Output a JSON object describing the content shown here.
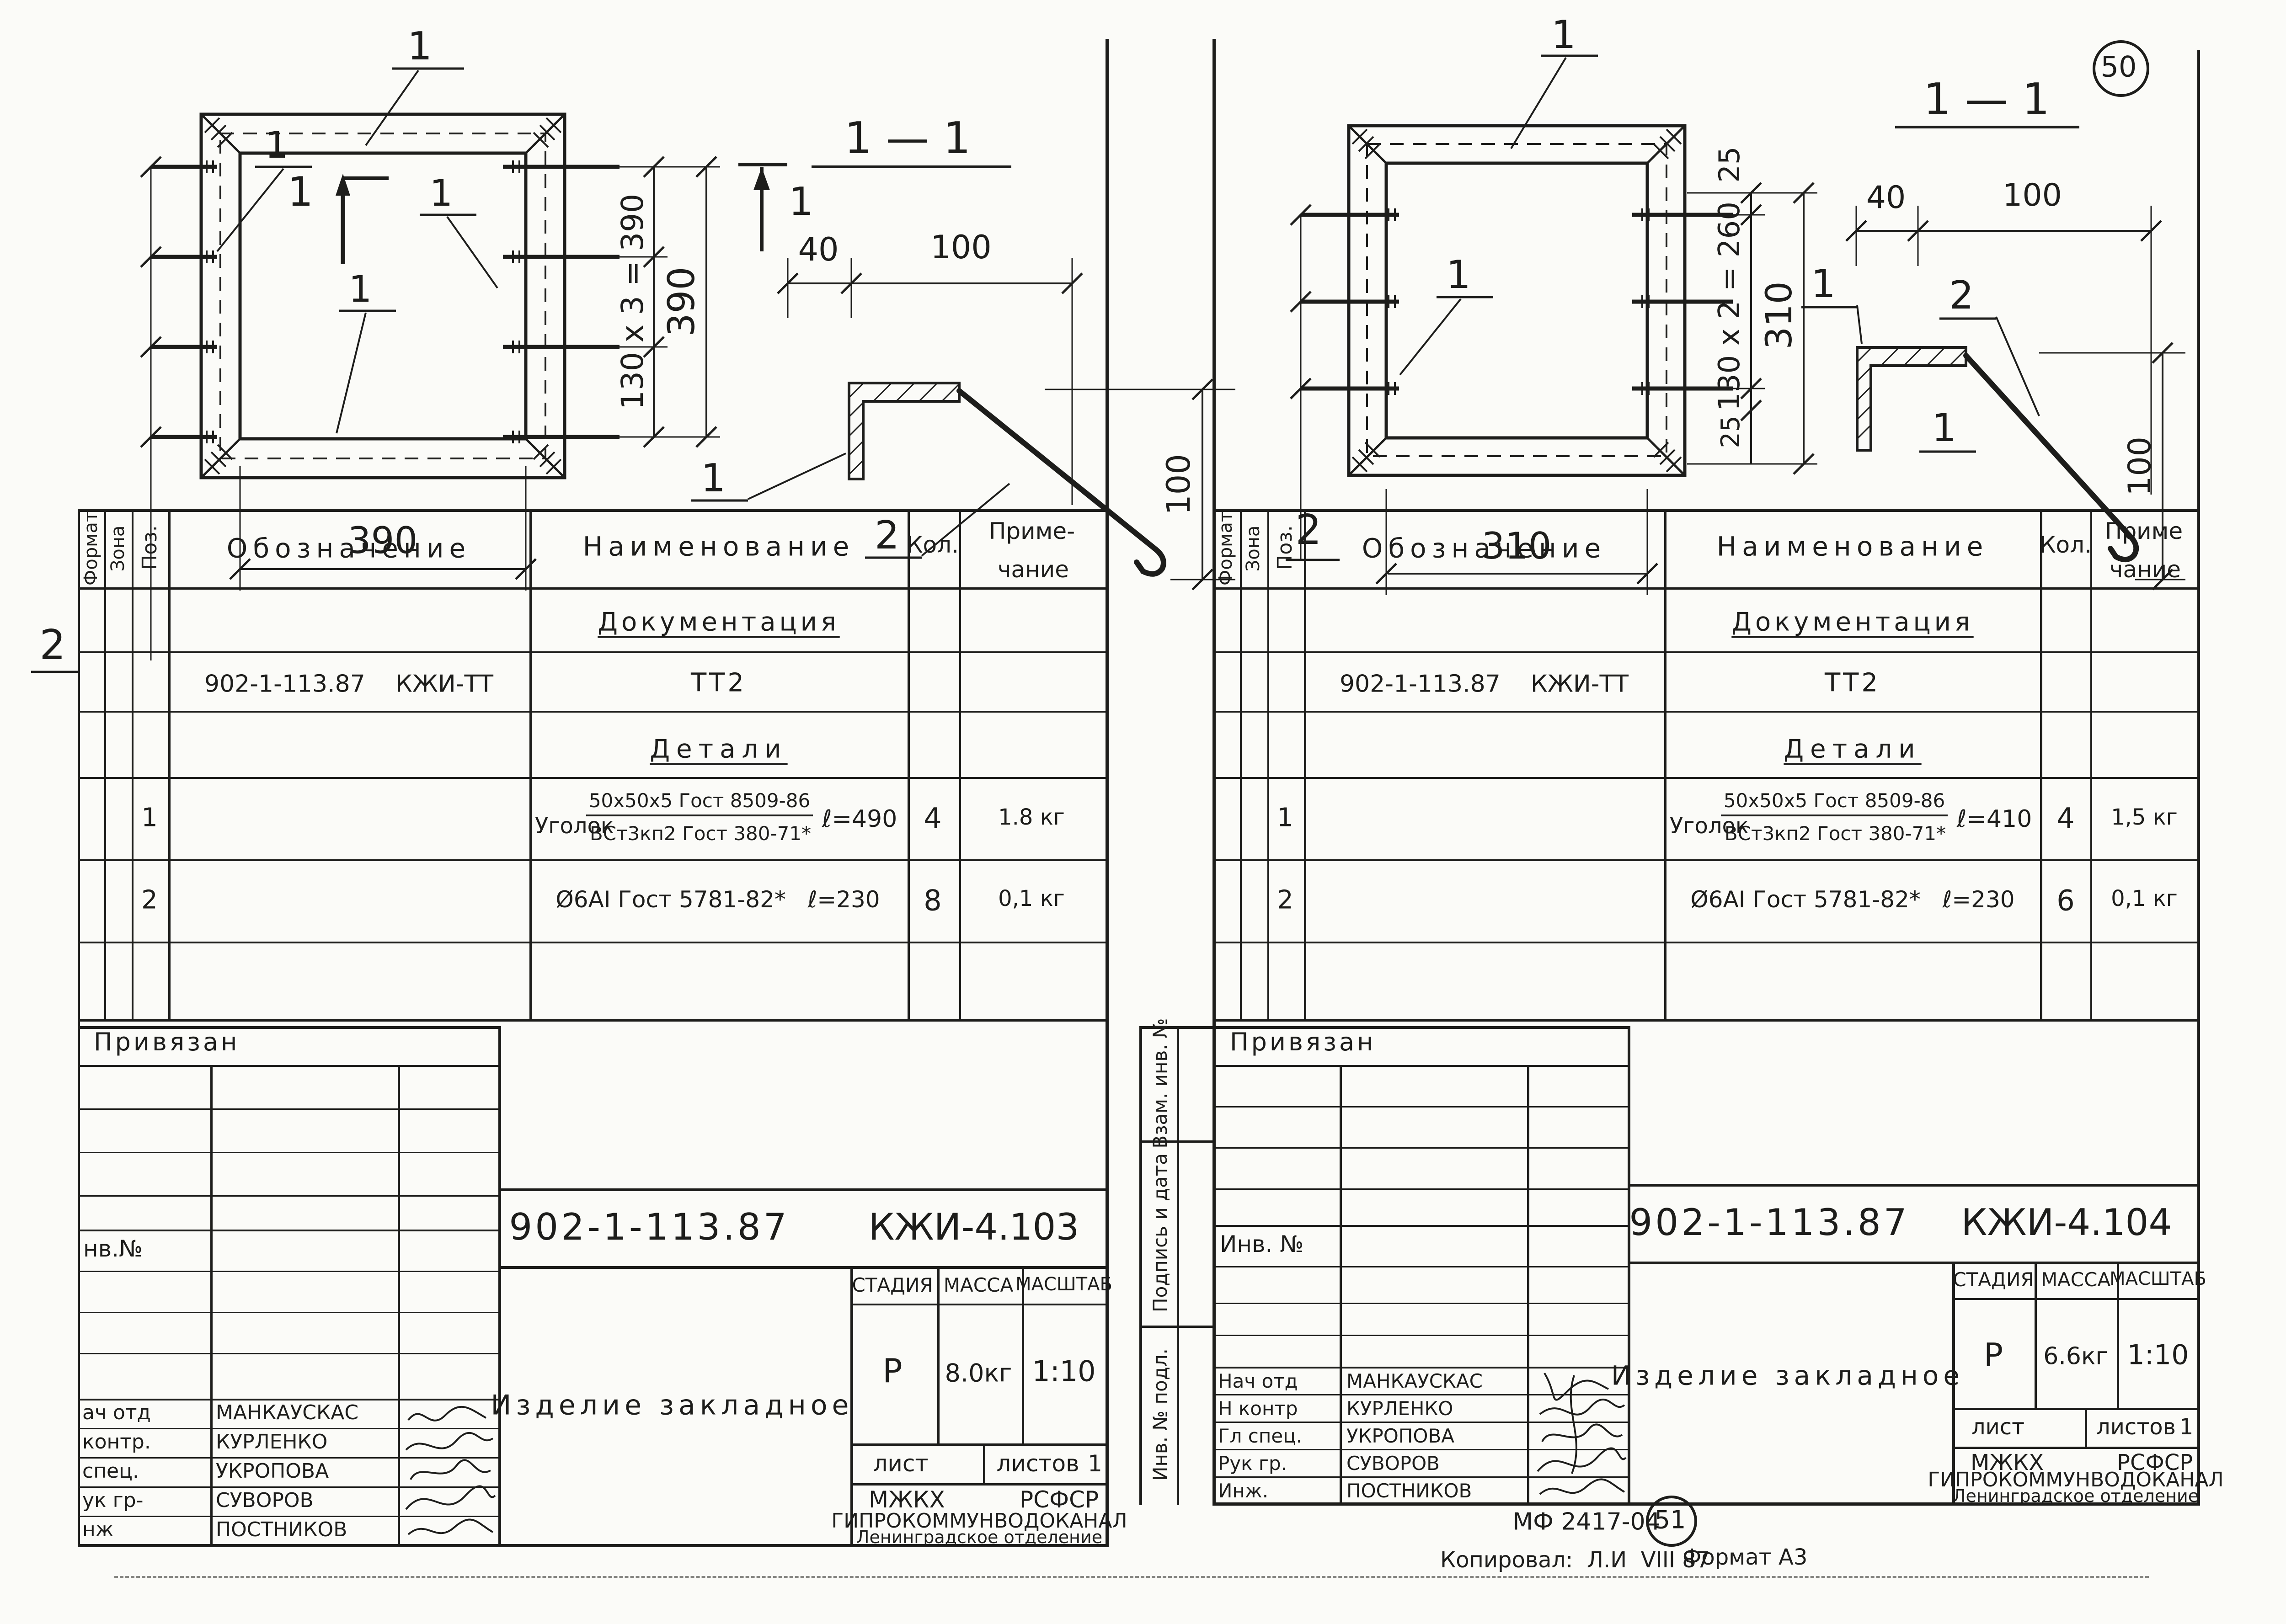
{
  "corner_mark": "50",
  "footer": {
    "stamp_code": "МФ 2417-04",
    "stamp_circle": "51",
    "copied": "Копировал:  Л.И  VIII 87",
    "format": "Формат А3"
  },
  "left": {
    "plan": {
      "l1_top": "1",
      "l1_left": "1",
      "l1_right": "1",
      "l1_bottom": "1",
      "sec_c": "1",
      "sec_r": "1",
      "label_2": "2",
      "dim_pitch": "130 x 3 = 390",
      "dim_side": "390",
      "dim_bottom": "390"
    },
    "sec": {
      "title": "1 — 1",
      "d40": "40",
      "d100": "100",
      "dh": "100",
      "p1": "1",
      "p2": "2"
    },
    "tbl": {
      "h_format": "Формат",
      "h_zone": "Зона",
      "h_pos": "Поз.",
      "h_desig": "Обозначение",
      "h_name": "Наименование",
      "h_qty": "Кол.",
      "h_note1": "Приме-",
      "h_note2": "чание",
      "s_doc": "Документация",
      "doc_desig": "902-1-113.87    КЖИ-ТТ",
      "doc_name": "ТТ2",
      "s_det": "Детали",
      "i1_pos": "1",
      "i1_pre": "Уголок",
      "i1_ft": "50x50x5 Гост 8509-86",
      "i1_fb": "ВСт3кп2 Гост 380-71*",
      "i1_len": "ℓ=490",
      "i1_qty": "4",
      "i1_note": "1.8 кг",
      "i2_pos": "2",
      "i2_name": "Ø6АI Гост 5781-82*   ℓ=230",
      "i2_qty": "8",
      "i2_note": "0,1 кг"
    },
    "stamp": {
      "top": "Привязан",
      "inv": "нв.№",
      "r1l": "ач отд",
      "r1n": "МАНКАУСКАС",
      "r2l": "контр.",
      "r2n": "КУРЛЕНКО",
      "r3l": "спец.",
      "r3n": "УКРОПОВА",
      "r4l": "ук гр-",
      "r4n": "СУВОРОВ",
      "r5l": "нж",
      "r5n": "ПОСТНИКОВ"
    },
    "tb": {
      "doc": "902-1-113.87",
      "code": "КЖИ-4.103",
      "product": "Изделие закладное",
      "stage_h": "СТАДИЯ",
      "mass_h": "МАССА",
      "scale_h": "МАСШТАБ",
      "stage": "Р",
      "mass": "8.0кг",
      "scale": "1:10",
      "sheet": "лист",
      "sheets": "листов",
      "sheets_n": "1",
      "org_a": "МЖКХ",
      "org_b": "РСФСР",
      "org_main": "ГИПРОКОММУНВОДОКАНАЛ",
      "org_br": "Ленинградское отделение"
    }
  },
  "right": {
    "plan": {
      "l1_top": "1",
      "l1_left": "1",
      "sec_r": "1",
      "label_2": "2",
      "dim_25t": "25",
      "dim_pitch": "130 x 2 = 260",
      "dim_25b": "25",
      "dim_side": "310",
      "dim_bottom": "310"
    },
    "sec": {
      "title": "1 — 1",
      "d40": "40",
      "d100": "100",
      "dh": "100",
      "p1": "1",
      "p2": "2"
    },
    "tbl": {
      "h_format": "Формат",
      "h_zone": "Зона",
      "h_pos": "Поз.",
      "h_desig": "Обозначение",
      "h_name": "Наименование",
      "h_qty": "Кол.",
      "h_note1": "Приме",
      "h_note2": "чание",
      "s_doc": "Документация",
      "doc_desig": "902-1-113.87    КЖИ-ТТ",
      "doc_name": "ТТ2",
      "s_det": "Детали",
      "i1_pos": "1",
      "i1_pre": "Уголок",
      "i1_ft": "50x50x5 Гост 8509-86",
      "i1_fb": "ВСт3кп2 Гост 380-71*",
      "i1_len": "ℓ=410",
      "i1_qty": "4",
      "i1_note": "1,5 кг",
      "i2_pos": "2",
      "i2_name": "Ø6АI Гост 5781-82*   ℓ=230",
      "i2_qty": "6",
      "i2_note": "0,1 кг"
    },
    "stamp": {
      "top": "Привязан",
      "inv": "Инв. №",
      "r1l": "Нач отд",
      "r1n": "МАНКАУСКАС",
      "r2l": "Н контр",
      "r2n": "КУРЛЕНКО",
      "r3l": "Гл спец.",
      "r3n": "УКРОПОВА",
      "r4l": "Рук гр.",
      "r4n": "СУВОРОВ",
      "r5l": "Инж.",
      "r5n": "ПОСТНИКОВ"
    },
    "sidebar": {
      "a": "Взам. инв. №",
      "b": "Подпись и дата",
      "c": "Инв. № подл."
    },
    "tb": {
      "doc": "902-1-113.87",
      "code": "КЖИ-4.104",
      "product": "Изделие закладное",
      "stage_h": "СТАДИЯ",
      "mass_h": "МАССА",
      "scale_h": "МАСШТАБ",
      "stage": "Р",
      "mass": "6.6кг",
      "scale": "1:10",
      "sheet": "лист",
      "sheets": "листов",
      "sheets_n": "1",
      "org_a": "МЖКХ",
      "org_b": "РСФСР",
      "org_main": "ГИПРОКОММУНВОДОКАНАЛ",
      "org_br": "Ленинградское отделение"
    }
  }
}
